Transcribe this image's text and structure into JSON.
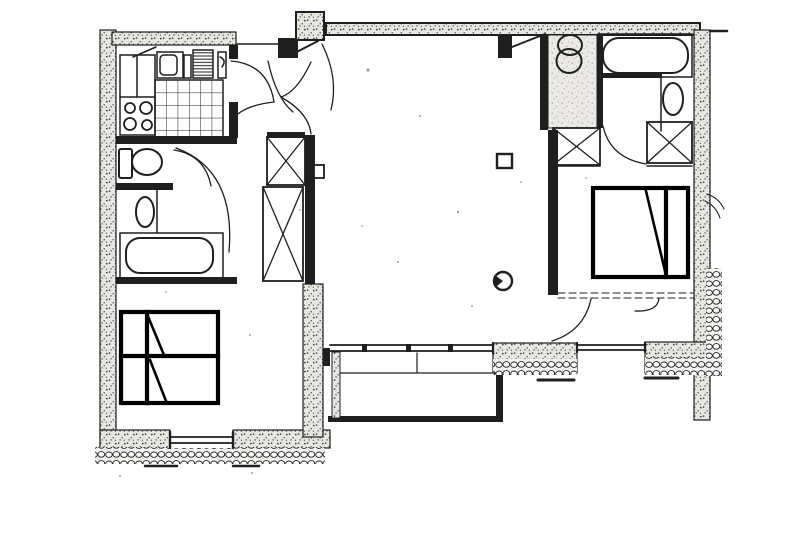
{
  "canvas": {
    "width": 800,
    "height": 558
  },
  "colors": {
    "paper": "#ffffff",
    "ink": "#1f1f1f",
    "speckle": "#3c3c3c",
    "wall_tint": "#e8e6e1",
    "shade_tint": "#eceae6",
    "shade_dot": "#8f8c88",
    "rubble_bg": "#f3f2ef",
    "marker": "#000000",
    "noise": "#555555"
  },
  "plan": {
    "type": "floor-plan",
    "style": "scanned black-ink apartment drawing, no text labels"
  },
  "symbols": {
    "exterior_wall": "exterior masonry wall (speckled)",
    "rubble": "rubble masonry band",
    "entrance_door": "apartment entrance door",
    "door_swing": "door swing arc",
    "kitchen_counter": "kitchen counter",
    "kitchen_stove": "4-burner stove",
    "kitchen_sink": "kitchen sink",
    "refrigerator": "refrigerator",
    "tiled_worktop": "tiled worktop",
    "toilet": "toilet",
    "washbasin": "washbasin",
    "bathtub": "bathtub",
    "wardrobe": "built-in wardrobe (X box)",
    "shaft": "ventilation shaft (X box)",
    "bed_marker": "bed highlighted with bold marker",
    "window": "window",
    "balcony": "balcony slab",
    "column": "small column mark",
    "drain": "round floor mark"
  }
}
